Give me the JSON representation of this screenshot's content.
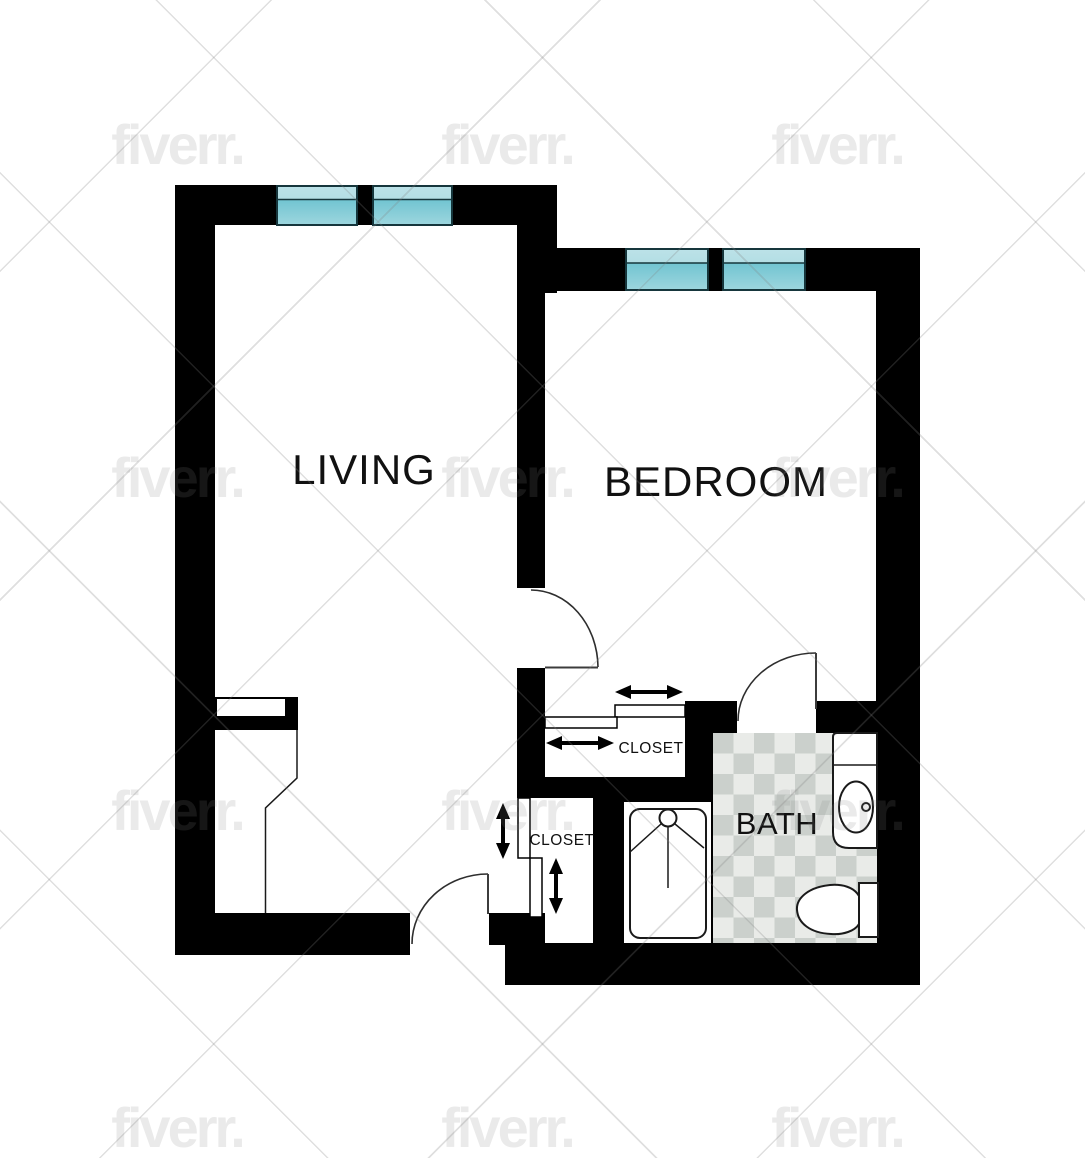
{
  "rooms": {
    "living": {
      "label": "LIVING"
    },
    "bedroom": {
      "label": "BEDROOM"
    },
    "bath": {
      "label": "BATH"
    },
    "bedroom_closet": {
      "label": "CLOSET"
    },
    "entry_closet": {
      "label": "CLOSET"
    }
  },
  "watermark": {
    "text": "fiverr."
  },
  "fixtures": [
    "window",
    "swing-door",
    "sliding-door-arrow",
    "shower",
    "vanity-sink",
    "toilet"
  ],
  "colors": {
    "wall": "#000000",
    "window_top_hi": "#bce2e8",
    "window_top_lo": "#a2d6dd",
    "window_bottom_hi": "#71c4d1",
    "window_bottom_lo": "#9dd6de",
    "tile_light": "#e9ebe8",
    "tile_dark": "#cbd0cc",
    "fixture_line": "#1a1a1a",
    "watermark_gray": "#808080"
  }
}
